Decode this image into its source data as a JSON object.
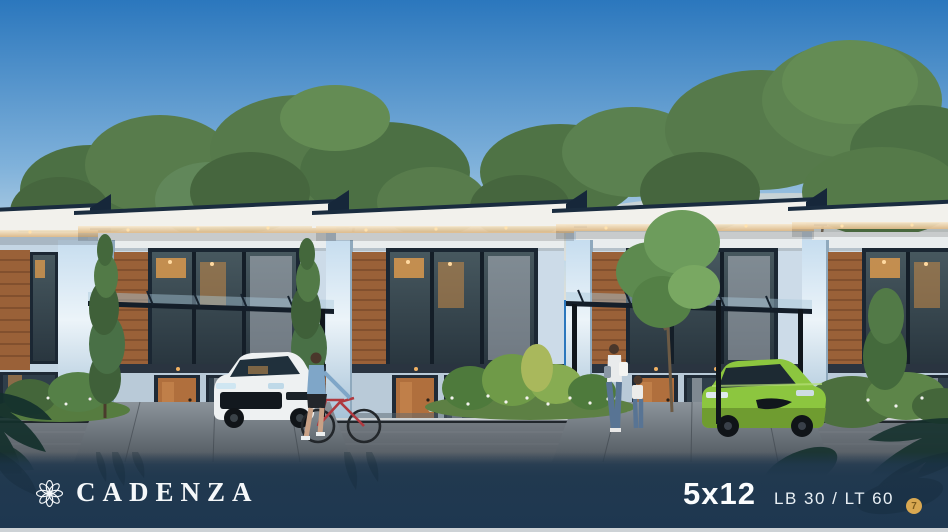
{
  "footer": {
    "brand": "CADENZA",
    "size": "5x12",
    "spec": "LB 30 / LT 60",
    "badge": "7"
  },
  "icons": {
    "logo": "eight-petal-flower-icon",
    "badge": "gold-numbered-circle-badge",
    "decor": "tropical-leaf-silhouette"
  },
  "colors": {
    "footer_bar": "#21394f",
    "badge_gold": "#d9a851",
    "sky_top": "#2b77bd",
    "sky_horizon": "#d9e2e2",
    "tree_green": "#567a4b",
    "roof_trim_navy": "#17293c",
    "wood_panel": "#9a6138",
    "door_wood": "#b06f3d",
    "wall_light": "#ccdbe8",
    "car_white": "#eef1f2",
    "car_green": "#8cc63f",
    "bike_red": "#b0393f",
    "street_gray": "#565d64",
    "text_white": "#f5f8fa"
  },
  "scene": {
    "type": "architectural-dusk-render",
    "elements": [
      "sky",
      "tree-line",
      "terrace-house-row",
      "carport-pergola",
      "white-hatchback-car",
      "green-hatchback-car",
      "cyclist-with-red-bike",
      "mother-and-child",
      "front-gardens",
      "street",
      "leaf-decorations"
    ]
  }
}
